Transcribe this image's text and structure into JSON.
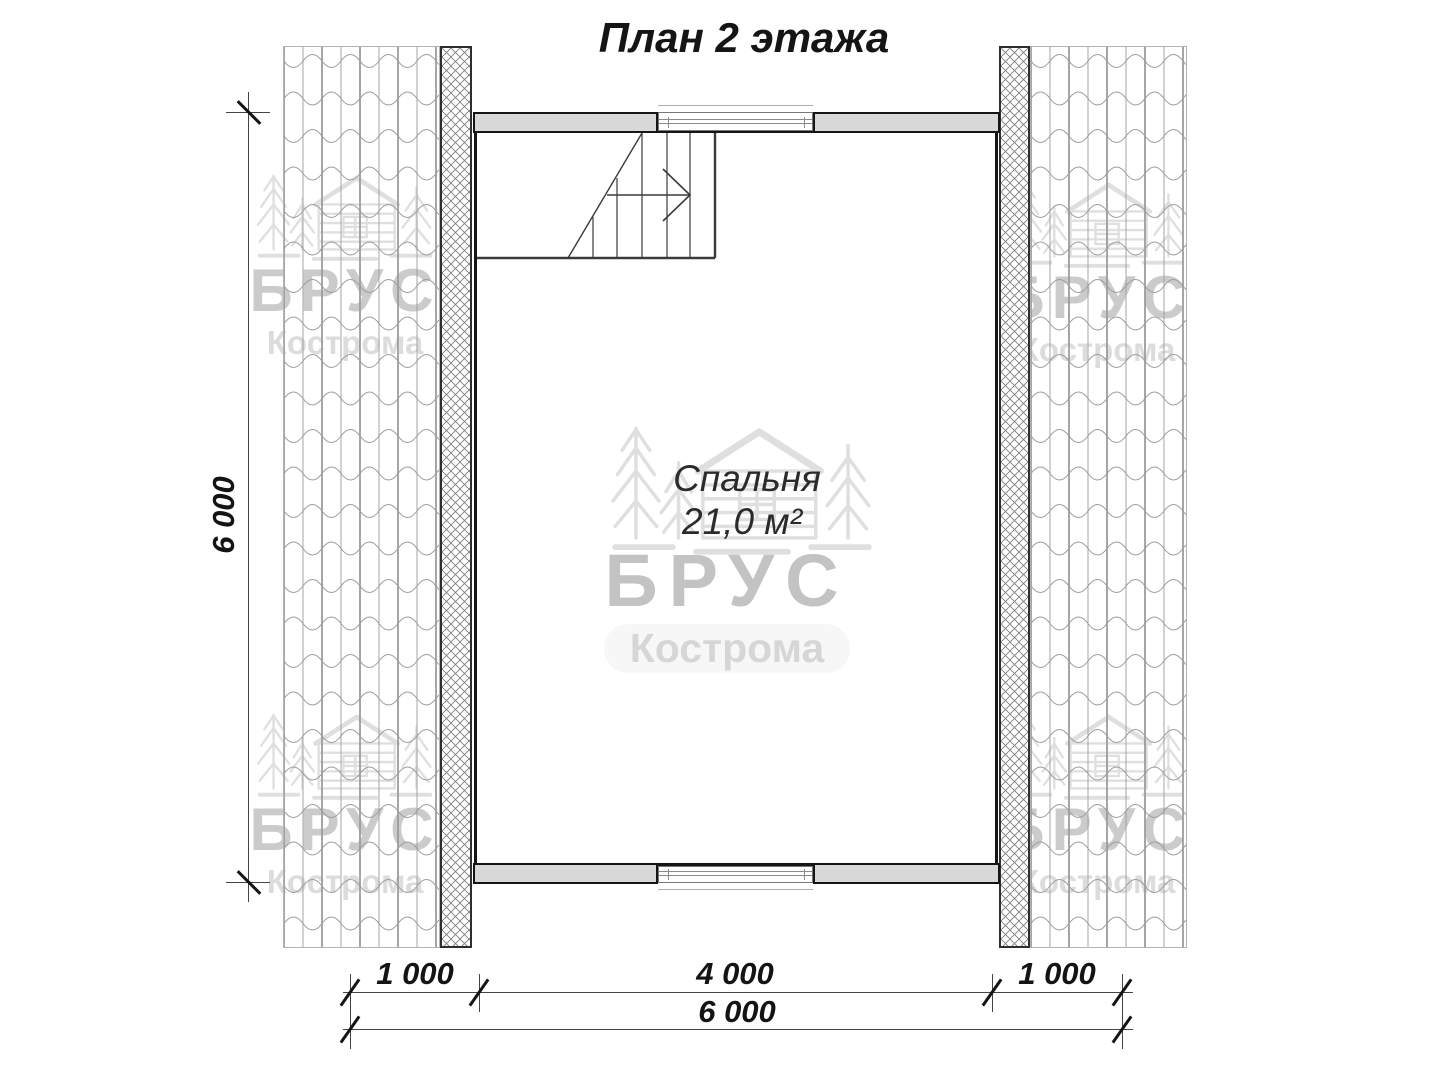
{
  "title": "План 2 этажа",
  "room": {
    "name": "Спальня",
    "area": "21,0 м²"
  },
  "dims": {
    "left_total": "6 000",
    "bottom_left": "1 000",
    "bottom_middle": "4 000",
    "bottom_right": "1 000",
    "bottom_total": "6 000"
  },
  "watermark": {
    "brand": "БРУС",
    "city": "Кострома"
  },
  "colors": {
    "wall_fill": "#d8d8d8",
    "wall_outline": "#151515",
    "dim_line": "#444444",
    "tile_line": "#9c9c9c",
    "hatch_line": "#777777",
    "watermark_brand": "#c8c8c8",
    "watermark_city": "#dcdcdc",
    "logo_stroke": "#dfdfdf"
  }
}
